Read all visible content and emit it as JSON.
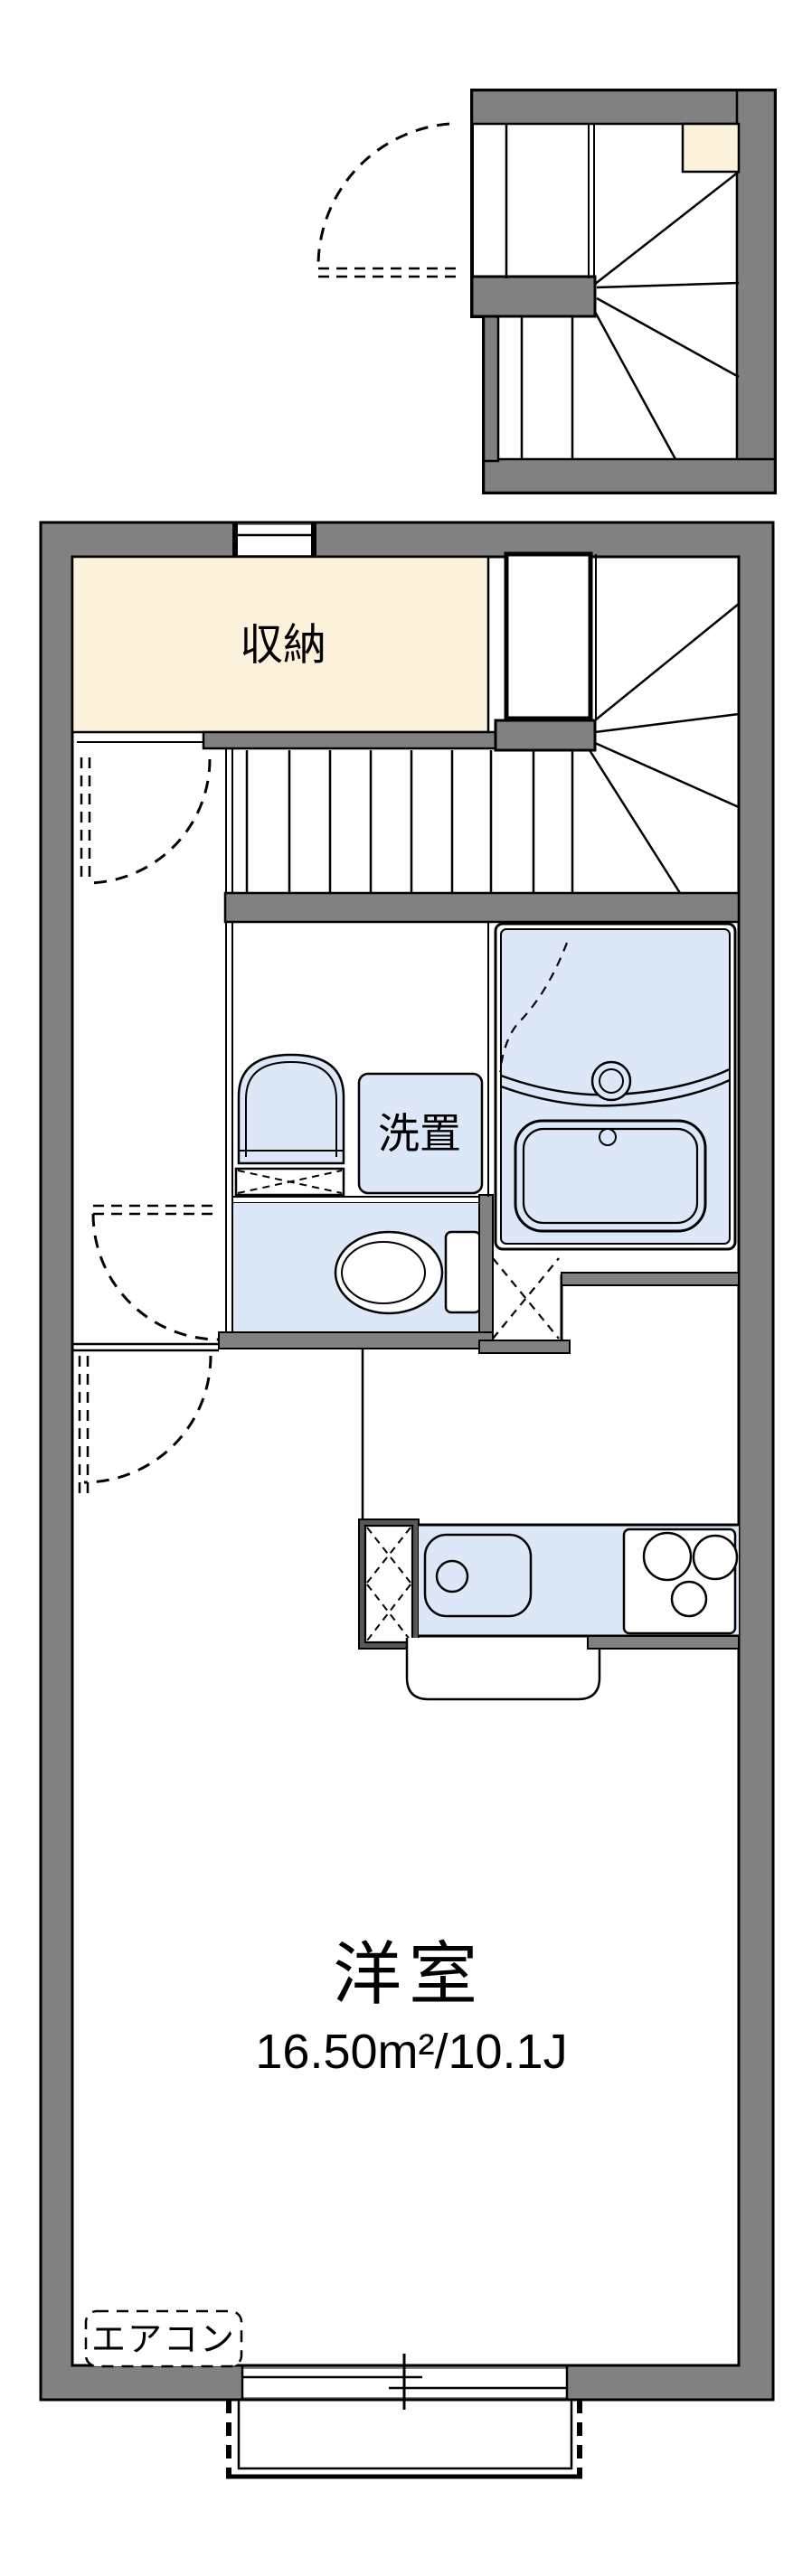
{
  "meta": {
    "drawing_type": "apartment floor plan"
  },
  "colors": {
    "wall": "#818181",
    "storage_fill": "#fcf1da",
    "fixture_fill": "#dce8f8",
    "fridge_frame": "#575757",
    "line": "#000000",
    "background": "#ffffff"
  },
  "rooms": {
    "storage": {
      "label": "収納"
    },
    "laundry": {
      "label": "洗置"
    },
    "main_room": {
      "label": "洋室",
      "size": "16.50m²/10.1J"
    },
    "aircon": {
      "label": "エアコン"
    }
  }
}
